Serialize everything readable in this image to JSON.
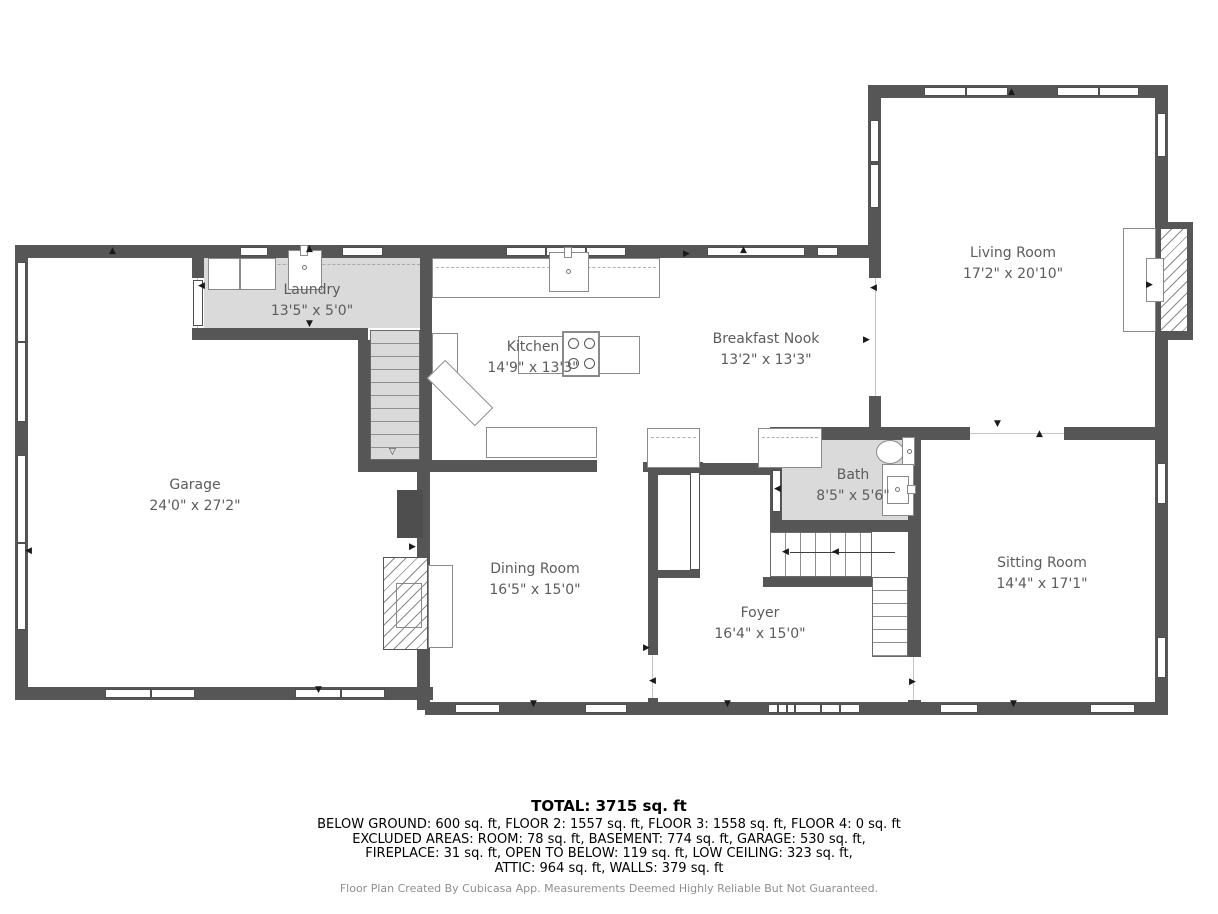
{
  "plan": {
    "rooms": [
      {
        "name": "Living Room",
        "dims": "17'2\" x 20'10\""
      },
      {
        "name": "Laundry",
        "dims": "13'5\" x 5'0\""
      },
      {
        "name": "Kitchen",
        "dims": "14'9\" x 13'3\""
      },
      {
        "name": "Breakfast Nook",
        "dims": "13'2\" x 13'3\""
      },
      {
        "name": "Garage",
        "dims": "24'0\" x 27'2\""
      },
      {
        "name": "Dining Room",
        "dims": "16'5\" x 15'0\""
      },
      {
        "name": "Foyer",
        "dims": "16'4\" x 15'0\""
      },
      {
        "name": "Bath",
        "dims": "8'5\" x 5'6\""
      },
      {
        "name": "Sitting Room",
        "dims": "14'4\" x 17'1\""
      }
    ],
    "symbols": {
      "up": "▲",
      "down": "▼",
      "left": "◀",
      "right": "▶",
      "stair_down": "▽"
    },
    "colors": {
      "wall": "#565656",
      "shaded_floor": "#dadada",
      "label_text": "#5c5c5c"
    }
  },
  "summary": {
    "total": "TOTAL: 3715 sq. ft",
    "line1": "BELOW GROUND: 600 sq. ft, FLOOR 2: 1557 sq. ft, FLOOR 3: 1558 sq. ft, FLOOR 4: 0 sq. ft",
    "line2": "EXCLUDED AREAS: ROOM: 78 sq. ft, BASEMENT: 774 sq. ft, GARAGE: 530 sq. ft,",
    "line3": "FIREPLACE: 31 sq. ft, OPEN TO BELOW: 119 sq. ft, LOW CEILING: 323 sq. ft,",
    "line4": "ATTIC: 964 sq. ft, WALLS: 379 sq. ft"
  },
  "footer": {
    "credit": "Floor Plan Created By Cubicasa App. Measurements Deemed Highly Reliable But Not Guaranteed."
  }
}
